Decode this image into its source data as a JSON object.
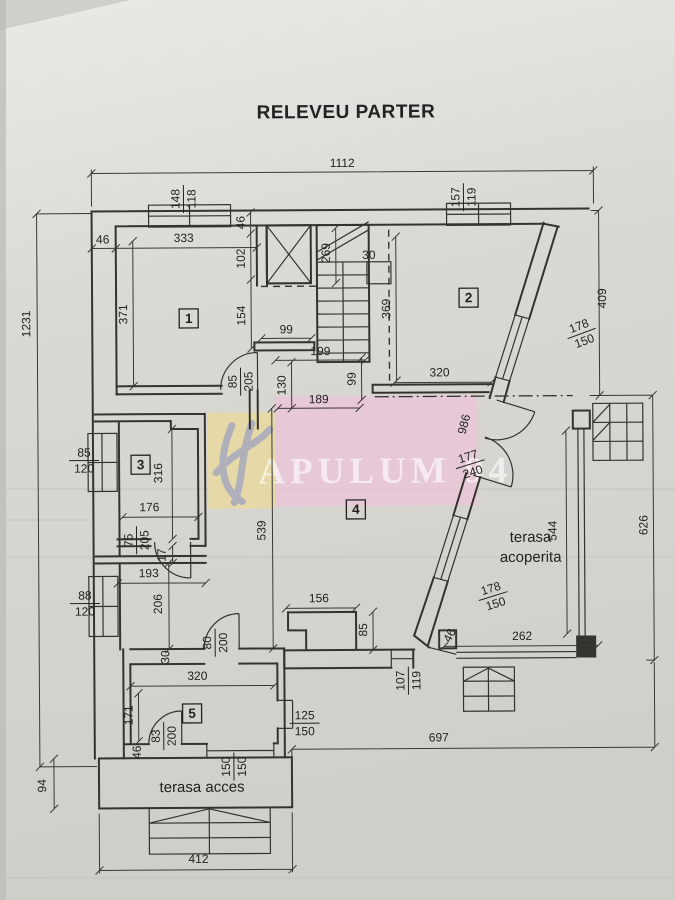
{
  "title": "RELEVEU PARTER",
  "watermark": {
    "text": "APULUM 94"
  },
  "rooms": {
    "r1": "1",
    "r2": "2",
    "r3": "3",
    "r4": "4",
    "r5": "5"
  },
  "areas": {
    "terasa_acoperita_line1": "terasa",
    "terasa_acoperita_line2": "acoperita",
    "terasa_acces": "terasa acces"
  },
  "dims": {
    "overall_top": "1112",
    "overall_left": "1231",
    "left_bottom": "94",
    "right_upper": "409",
    "right_lower": "626",
    "bottom_right": "697",
    "bottom_left": "412",
    "terrace_bottom": "262",
    "terrace_right": "544",
    "diag_wall": "986",
    "wall_46_topleft": "46",
    "room1_width": "333",
    "room1_height": "371",
    "v46_top": "46",
    "v102": "102",
    "v154": "154",
    "stair_width": "269",
    "stair_30": "30",
    "hall_99": "99",
    "hall_199": "199",
    "hall_130": "130",
    "hall_99v": "99",
    "hall_189": "189",
    "room2_height": "369",
    "room2_width": "320",
    "room3_height": "316",
    "room3_width": "176",
    "wall_17": "17",
    "seg_193": "193",
    "seg_206": "206",
    "room4_height": "539",
    "bump_width": "156",
    "bump_height": "85",
    "wall_30v": "30",
    "room5_width": "320",
    "room5_height": "171",
    "wall_46_bl": "46",
    "diag_46": "46"
  },
  "fractions": {
    "win_top_left": {
      "a": "148",
      "b": "118"
    },
    "win_top_right": {
      "a": "157",
      "b": "119"
    },
    "win_left_upper": {
      "a": "85",
      "b": "120"
    },
    "win_left_lower": {
      "a": "88",
      "b": "120"
    },
    "door_room1": {
      "a": "85",
      "b": "205"
    },
    "door_room3": {
      "a": "75",
      "b": "205"
    },
    "door_room5_top": {
      "a": "80",
      "b": "200"
    },
    "door_room5_bot": {
      "a": "83",
      "b": "200"
    },
    "win_room5_right": {
      "a": "125",
      "b": "150"
    },
    "opening_room5": {
      "a": "150",
      "b": "150"
    },
    "win_bottom": {
      "a": "107",
      "b": "119"
    },
    "win_diag_upper": {
      "a": "178",
      "b": "150"
    },
    "door_diag": {
      "a": "177",
      "b": "240"
    },
    "win_diag_lower": {
      "a": "178",
      "b": "150"
    }
  },
  "colors": {
    "ink": "#34332f",
    "watermark_pink": "#eac4d8",
    "watermark_yellow": "#e9d9a0",
    "watermark_logo_blue": "#8a94c6"
  }
}
